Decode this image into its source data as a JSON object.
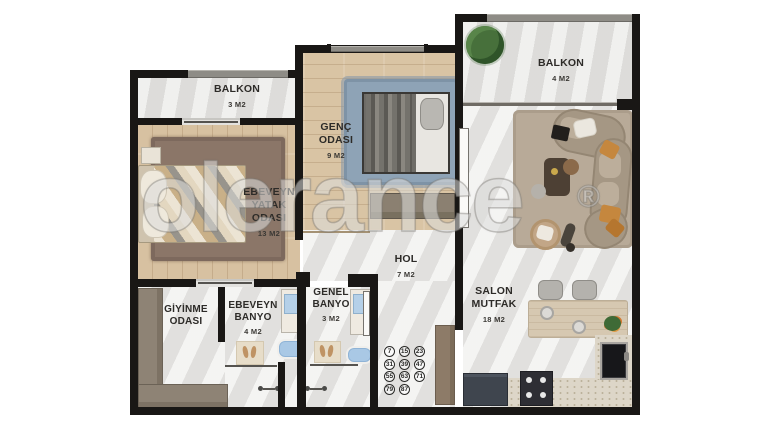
{
  "watermark": {
    "text": "olerance",
    "symbol": "®"
  },
  "rooms": {
    "balkon_left": {
      "name": "BALKON",
      "size": "3 M2"
    },
    "master_bedroom": {
      "line1": "EBEVEYN",
      "line2": "YATAK",
      "line3": "ODASI",
      "size": "13 M2"
    },
    "genc_odasi": {
      "line1": "GENÇ",
      "line2": "ODASI",
      "size": "9 M2"
    },
    "balkon_right": {
      "name": "BALKON",
      "size": "4 M2"
    },
    "salon_mutfak": {
      "line1": "SALON",
      "line2": "MUTFAK",
      "size": "18 M2"
    },
    "hol": {
      "name": "HOL",
      "size": "7 M2"
    },
    "giyinme_odasi": {
      "line1": "GİYİNME",
      "line2": "ODASI"
    },
    "ebeveyn_banyo": {
      "line1": "EBEVEYN",
      "line2": "BANYO",
      "size": "4 M2"
    },
    "genel_banyo": {
      "line1": "GENEL",
      "line2": "BANYO",
      "size": "3 M2"
    }
  },
  "unit_numbers": [
    "7",
    "15",
    "23",
    "31",
    "39",
    "47",
    "55",
    "63",
    "71",
    "79",
    "87"
  ],
  "colors": {
    "wall": "#191715",
    "wood_floor": "#d8c2a2",
    "marble_floor": "#e9e8e6",
    "rug_brown": "#8b7668",
    "rug_blue": "#8ea3b6",
    "rug_salon": "#b8aa98",
    "accent_orange": "#c5873e",
    "tub_blue": "#a9c8e5"
  }
}
